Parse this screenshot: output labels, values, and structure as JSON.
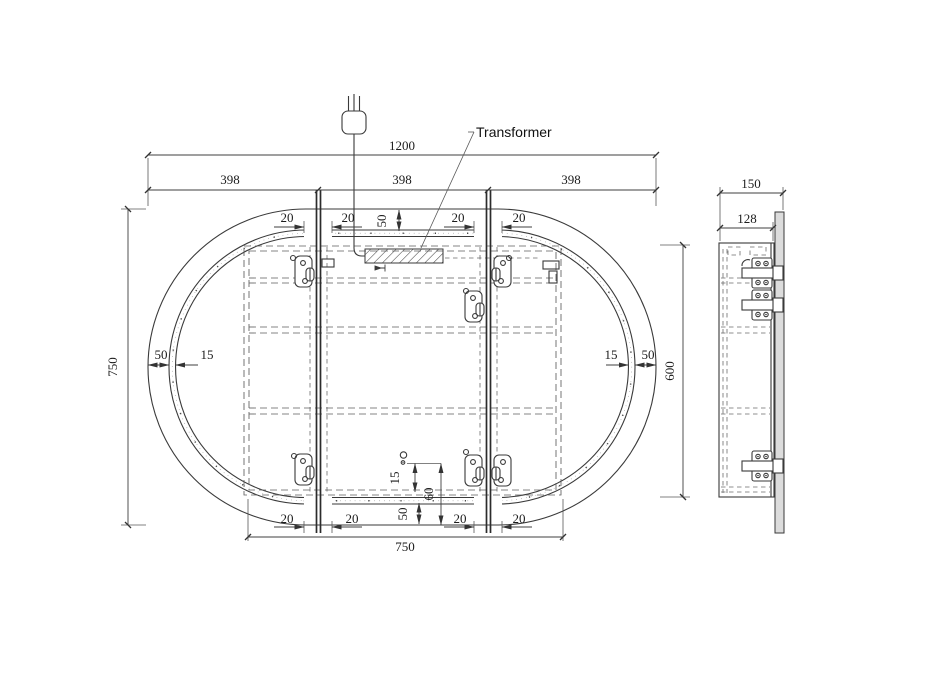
{
  "drawing": {
    "transformer_label": "Transformer",
    "front": {
      "total_width": "1200",
      "span_left": "398",
      "span_mid": "398",
      "span_right": "398",
      "total_height": "750",
      "plate_width": "750",
      "plate_height": "600",
      "edge_gap_left": "50",
      "strip_width_left": "15",
      "strip_width_right": "15",
      "edge_gap_right": "50",
      "top_gap_outer_left": "20",
      "top_gap_inner_left": "20",
      "top_strip_offset": "50",
      "top_gap_inner_right": "20",
      "top_gap_outer_right": "20",
      "bottom_gap_outer_left": "20",
      "bottom_gap_inner_left": "20",
      "bottom_strip_offset": "50",
      "bottom_gap_inner_right": "20",
      "bottom_gap_outer_right": "20",
      "sensor_offset": "15",
      "sensor_height": "60"
    },
    "side": {
      "total_depth": "150",
      "frame_depth": "128"
    }
  }
}
